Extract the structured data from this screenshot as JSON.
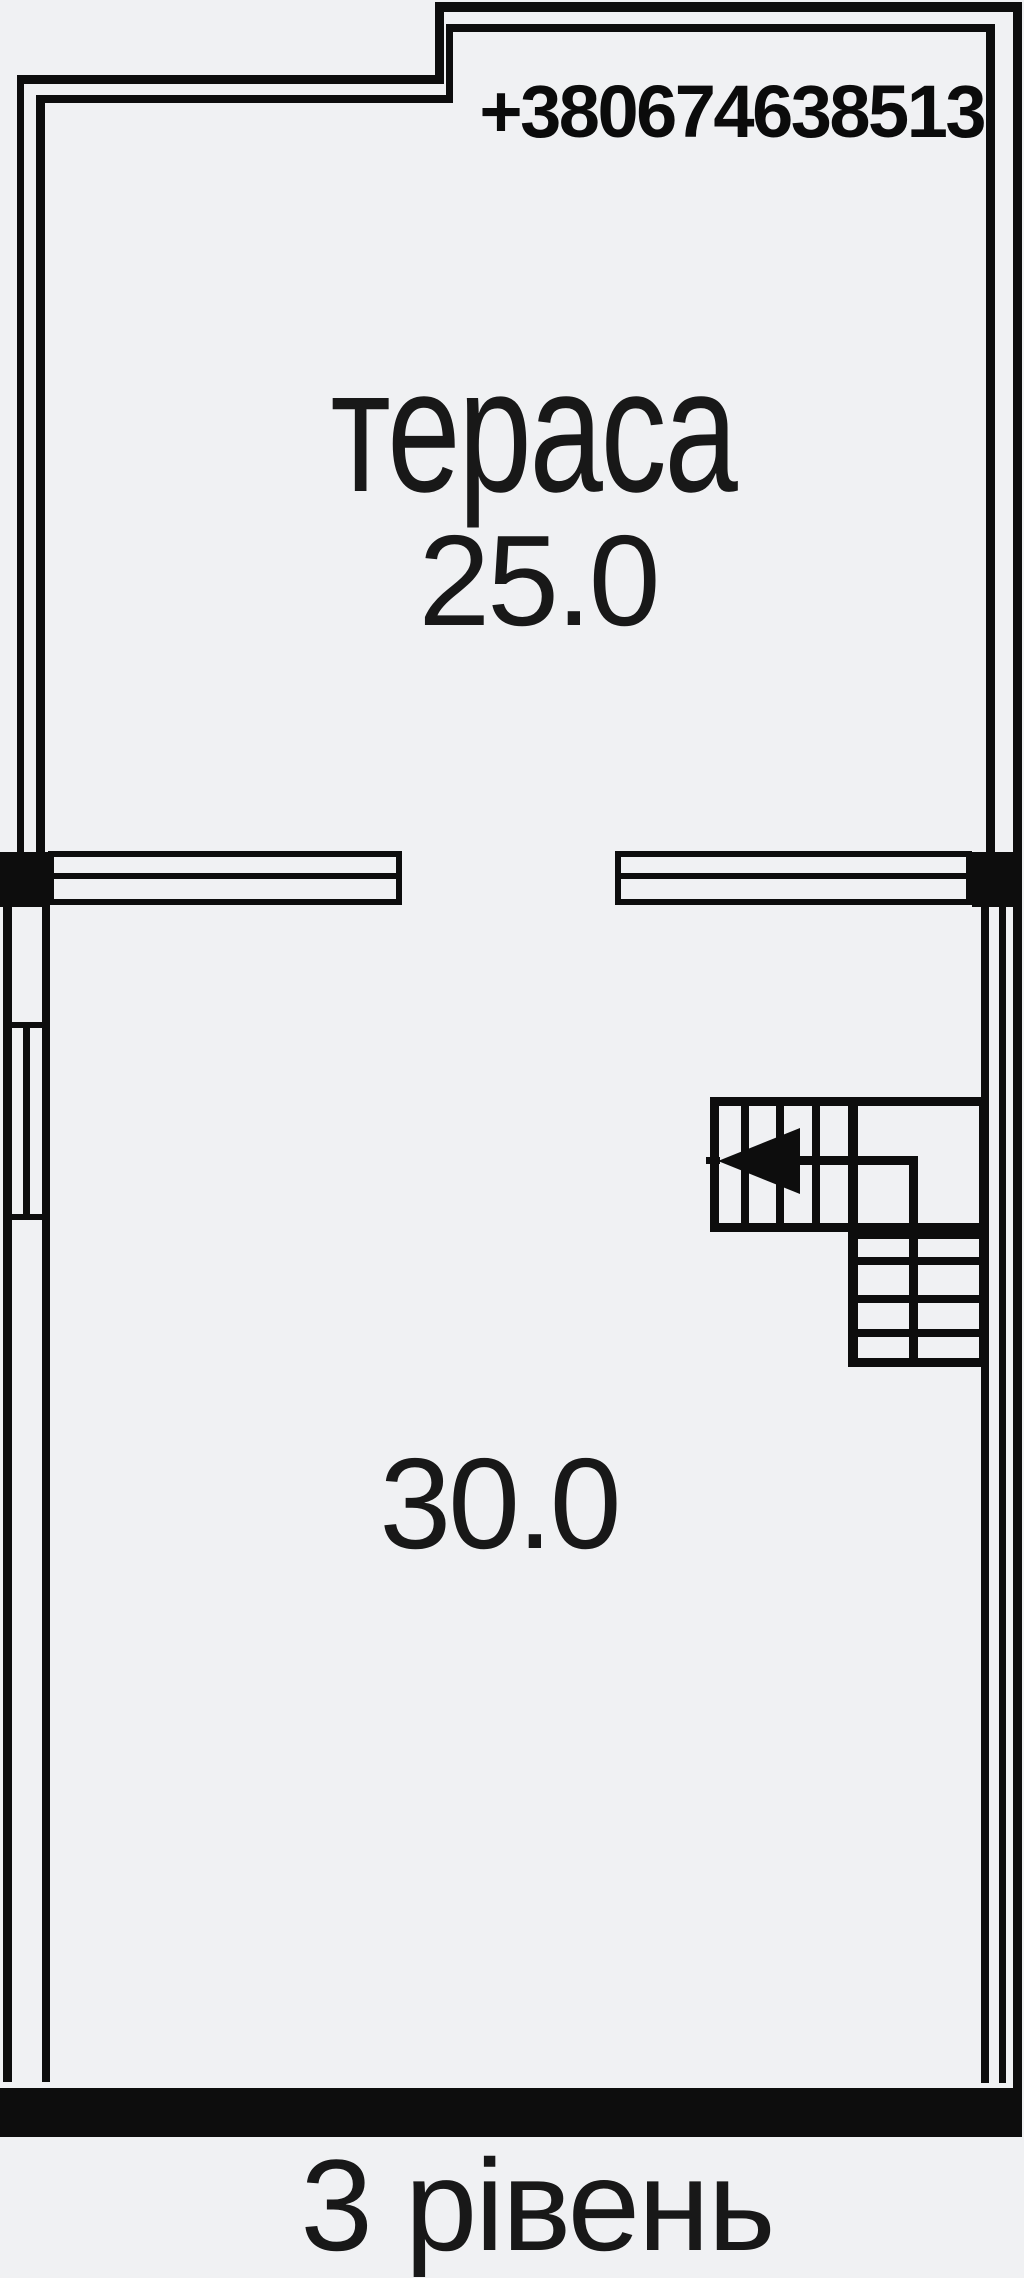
{
  "colors": {
    "background": "#f0f1f3",
    "line": "#0d0d0d",
    "text": "#181818"
  },
  "contact": {
    "phone": "+380674638513"
  },
  "rooms": {
    "terrace": {
      "name": "тераса",
      "area": "25.0"
    },
    "main": {
      "area": "30.0"
    }
  },
  "stairs": {
    "shape": "L-shaped",
    "direction_arrow": "left"
  },
  "footer": {
    "level_label": "3 рівень"
  }
}
